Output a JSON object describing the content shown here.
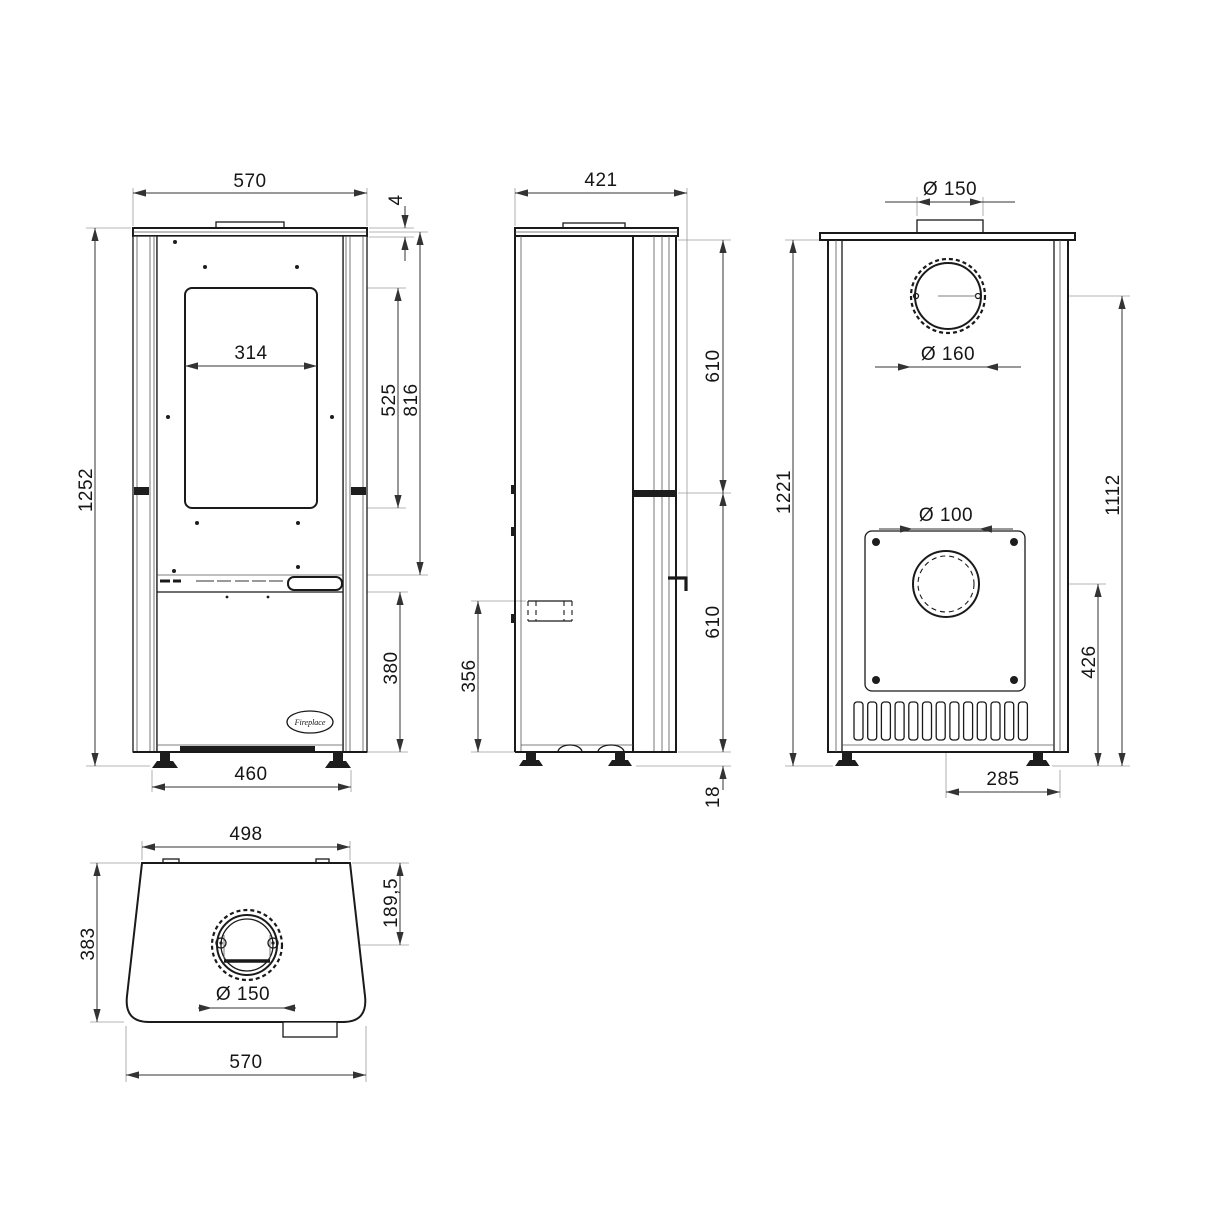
{
  "colors": {
    "line": "#1a1a1a",
    "dimension": "#333333",
    "background": "#ffffff"
  },
  "drawing": {
    "front_view": {
      "width_top": "570",
      "top_plate_lip": "4",
      "glass_width": "314",
      "glass_height": "525",
      "firebox_height": "816",
      "total_height": "1252",
      "base_door_height": "380",
      "feet_spacing": "460",
      "logo": "Fireplace"
    },
    "side_view": {
      "depth": "421",
      "upper_height": "610",
      "lower_height": "610",
      "side_inlet_height": "356",
      "foot_height": "18"
    },
    "back_view": {
      "flue_collar_diameter": "Ø 150",
      "flue_hole_diameter": "Ø 160",
      "total_height": "1221",
      "flue_center_height": "1112",
      "air_inlet_diameter": "Ø 100",
      "air_inlet_center_height": "426",
      "air_inlet_offset": "285"
    },
    "top_view": {
      "top_width": "498",
      "flue_center_offset": "189,5",
      "depth": "383",
      "flue_diameter": "Ø 150",
      "bottom_width": "570"
    }
  }
}
